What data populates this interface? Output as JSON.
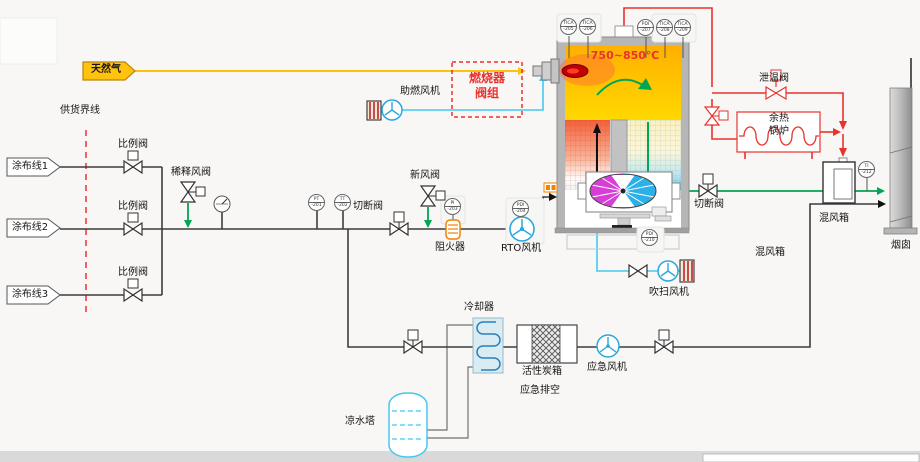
{
  "labels": {
    "natural_gas": "天然气",
    "supply_boundary": "供货界线",
    "coating_line_1": "涂布线1",
    "coating_line_2": "涂布线2",
    "coating_line_3": "涂布线3",
    "proportional_valve": "比例阀",
    "dilution_valve": "稀释风阀",
    "shutoff_valve": "切断阀",
    "fresh_air_valve": "新风阀",
    "flame_arrester": "阻火器",
    "rto_fan": "RTO风机",
    "combustion_fan": "助燃风机",
    "burner_group_l1": "燃烧器",
    "burner_group_l2": "阀组",
    "relief_valve": "泄温阀",
    "boiler_l1": "余热",
    "boiler_l2": "锅炉",
    "mix_box": "混风箱",
    "chimney": "烟囱",
    "purge_fan": "吹扫风机",
    "cooler": "冷却器",
    "carbon_box": "活性炭箱",
    "emergency_vent": "应急排空",
    "emergency_fan": "应急风机",
    "cooling_tower": "凉水塔"
  },
  "furnace": {
    "temp_range": "750~850℃"
  },
  "instruments": {
    "pt": {
      "l1": "PT",
      "l2": "-201"
    },
    "tt": {
      "l1": "TT",
      "l2": "-202"
    },
    "pi": {
      "l1": "PI",
      "l2": "-203"
    },
    "pdi_fan": {
      "l1": "PDI",
      "l2": "-204"
    },
    "tica1": {
      "l1": "TICA",
      "l2": "-205"
    },
    "tica2": {
      "l1": "TICA",
      "l2": "-206"
    },
    "pdi_top": {
      "l1": "PDI",
      "l2": "-207"
    },
    "tica3": {
      "l1": "TICA",
      "l2": "-208"
    },
    "tica4": {
      "l1": "TICA",
      "l2": "-209"
    },
    "pdi_bot": {
      "l1": "PDI",
      "l2": "-210"
    },
    "ti_mix": {
      "l1": "TI",
      "l2": "-212"
    }
  },
  "colors": {
    "pipe": "#3c3c3c",
    "red": "#e8322e",
    "green": "#00a651",
    "cyan": "#45c8f0",
    "yellow": "#ffc20e",
    "orange": "#f08300",
    "rotor_left": "#d63ed6",
    "rotor_right": "#2bb1e8"
  }
}
